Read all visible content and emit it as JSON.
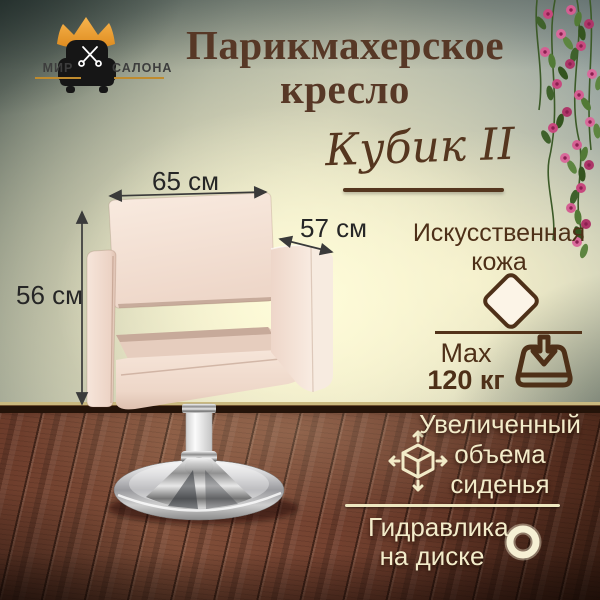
{
  "brand": {
    "left": "МИР",
    "right": "САЛОНА"
  },
  "title": {
    "line1": "Парикмахерское",
    "line2": "кресло"
  },
  "model": {
    "name": "Кубик II"
  },
  "dimensions": {
    "width": "65 см",
    "depth": "57 см",
    "height": "56 см"
  },
  "features": {
    "material": {
      "line1": "Искусственная",
      "line2": "кожа"
    },
    "weight": {
      "label": "Max",
      "value": "120 кг"
    },
    "seat": {
      "line1": "Увеличенный",
      "line2": "объема",
      "line3": "сиденья"
    },
    "hydraulics": {
      "line1": "Гидравлика",
      "line2": "на диске"
    }
  },
  "icons": {
    "logo_crown": "crown-icon",
    "logo_chair": "armchair-icon",
    "logo_scissors": "scissors-icon",
    "material_swatch": "diamond-swatch-icon",
    "max_weight": "weight-down-arrow-icon",
    "seat_volume": "cube-3d-arrows-icon",
    "hydraulics": "disc-ring-icon",
    "dimension_marks": "double-arrow"
  },
  "colors": {
    "title_brown": "#573826",
    "feature_brown": "#4e3018",
    "cream_text": "#f3ecca",
    "gold_underline": "#bf8b2e",
    "crown_gold": "#f1a438",
    "upholstery": "#f3e0d4",
    "wall_glow": "#fdf8d6",
    "floor_brown": "#6f4030",
    "flower_pink": "#c7487e"
  }
}
